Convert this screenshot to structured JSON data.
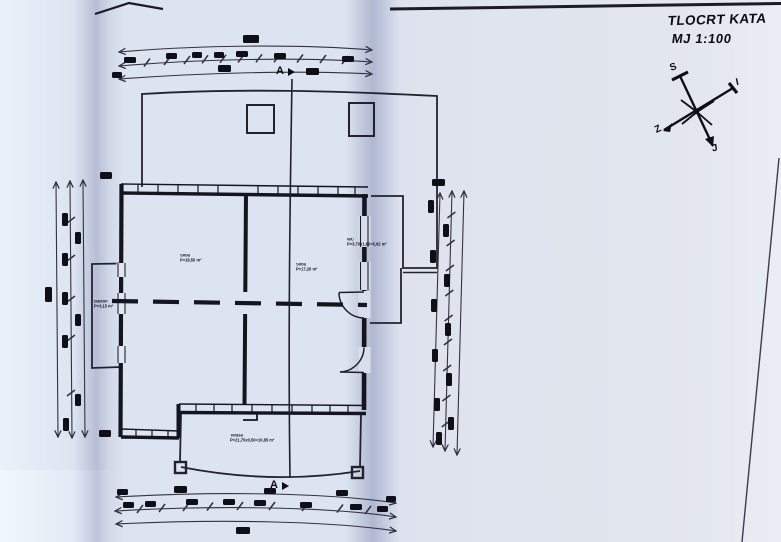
{
  "sheet": {
    "title": "TLOCRT KATA",
    "scale": "MJ 1:100"
  },
  "compass": {
    "north": "S",
    "east": "I",
    "west": "Z",
    "south": "J"
  },
  "section": {
    "top": "A",
    "bottom": "A"
  },
  "rooms": {
    "left": {
      "name": "Soba",
      "area": "P=18,50 m²"
    },
    "right": {
      "name": "Soba",
      "area": "P=17,20 m²"
    },
    "side": {
      "name": "WC",
      "area": "P=3,70x1,60=5,92 m²"
    },
    "terrace": {
      "name": "Terasa",
      "area": "P=21,75x0,50=10,85 m²"
    },
    "balcony": {
      "name": "Balkon",
      "area": "P=3,15 m²"
    }
  }
}
